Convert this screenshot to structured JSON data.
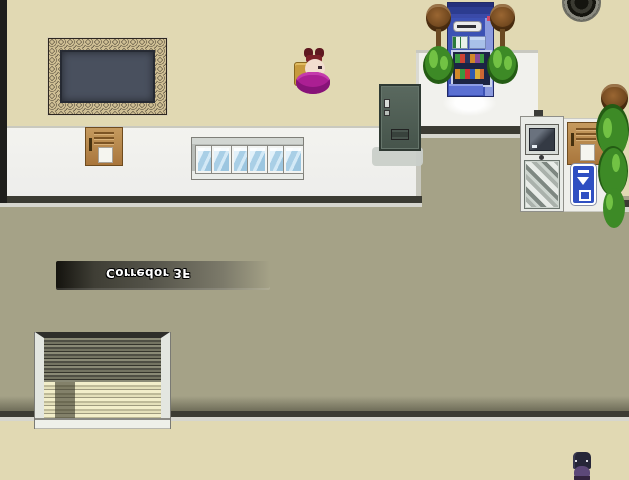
{
  "scene": {
    "name": "rpg-school-corridor",
    "orientation": "vertically-flipped",
    "sign": {
      "text": "Corredor 3F"
    },
    "colors": {
      "room_floor": "#e1d9b3",
      "corridor_floor": "#a5a287",
      "wall_white": "#ededeb",
      "kiosk_white": "#f1f1ed",
      "edge_dark": "#3b3b33",
      "edge_light": "#d6d6ce",
      "left_strip": "#1e1e1c",
      "board_slate": "#49505e",
      "board_frame": "#4e4234",
      "vending_body": "#3c51b4",
      "vending_side": "#8b9ade",
      "elevator_sign_blue": "#2f4fc2",
      "plant_green": "#3d8a26",
      "plant_green_light": "#72c244",
      "hair_magenta": "#ab1f93"
    }
  }
}
